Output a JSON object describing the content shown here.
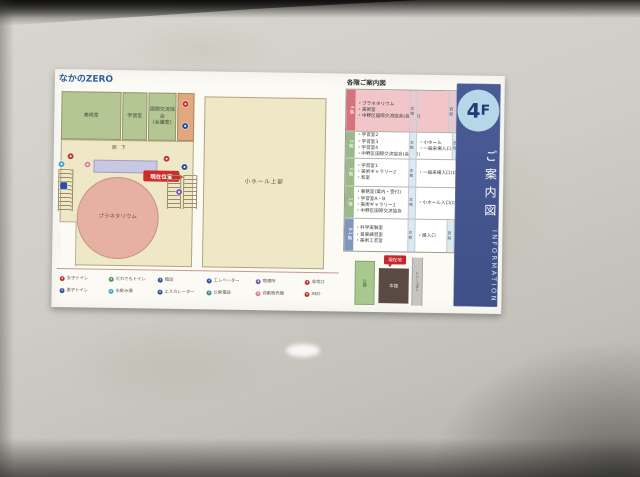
{
  "sign": {
    "logo": "なかのZERO",
    "map": {
      "room_art": "美術室",
      "room_study": "学習室",
      "room_exchange_line1": "国際交流協会",
      "room_exchange_line2": "(会議室)",
      "corridor": "廊下",
      "planetarium": "プラネタリウム",
      "hall_upper": "小ホール上部",
      "current_location": "現在位置"
    },
    "directory": {
      "title": "各階ご案内図",
      "main_label": "本館",
      "west_label": "西館",
      "rows": [
        {
          "floor": "4階",
          "left": [
            "・プラネタリウム",
            "・美術室",
            "・中野区国際交流協会(会議室)"
          ],
          "right": []
        },
        {
          "floor": "3階",
          "left": [
            "・学習室2",
            "・学習室3",
            "・学習室4",
            "・中野区国際交流協会(会議室)"
          ],
          "right": [
            "・小ホール",
            "・一般来場入口"
          ]
        },
        {
          "floor": "2階",
          "left": [
            "・学習室1",
            "・美術ギャラリー2",
            "・和室"
          ],
          "right": [
            "・一般来場入口(ロビー)"
          ]
        },
        {
          "floor": "1階",
          "left": [
            "・事務室(案内・受付)",
            "・学習室A・B",
            "・美術ギャラリー1",
            "・中野区国際交流協会"
          ],
          "right": [
            "・小ホール入口(ロビー)"
          ]
        },
        {
          "floor": "B1階",
          "left": [
            "・科学実験室",
            "・音楽練習室",
            "・美術工芸室"
          ],
          "right": [
            "・搬入口"
          ]
        }
      ]
    },
    "minimap": {
      "park": "公園",
      "main_building": "本館",
      "current": "現在地",
      "road": "もみじ山通り"
    },
    "legend": {
      "items": [
        {
          "icon": "female-toilet-icon",
          "label": "女子トイレ"
        },
        {
          "icon": "male-toilet-icon",
          "label": "男子トイレ"
        },
        {
          "icon": "accessible-toilet-icon",
          "label": "だれでもトイレ"
        },
        {
          "icon": "drinking-fountain-icon",
          "label": "水飲み場"
        },
        {
          "icon": "stairs-icon",
          "label": "階段"
        },
        {
          "icon": "escalator-icon",
          "label": "エスカレーター"
        },
        {
          "icon": "elevator-icon",
          "label": "エレベーター"
        },
        {
          "icon": "phone-icon",
          "label": "公衆電話"
        },
        {
          "icon": "smoking-icon",
          "label": "喫煙所"
        },
        {
          "icon": "vending-icon",
          "label": "自動販売機"
        },
        {
          "icon": "exit-icon",
          "label": "非常口"
        },
        {
          "icon": "aed-icon",
          "label": "AED"
        }
      ]
    },
    "strip": {
      "floor": "4",
      "floor_suffix": "F",
      "title": "ご案内図",
      "subtitle": "INFORMATION"
    },
    "colors": {
      "strip_blue": "#45568f",
      "floor_badge_blue": "#b5d7e8",
      "highlight_pink": "#f2c6c9",
      "map_green": "#b3c693",
      "map_cream": "#efe8c6",
      "map_circle_pink": "#e6b1a2",
      "current_red": "#cf2b2b"
    }
  }
}
